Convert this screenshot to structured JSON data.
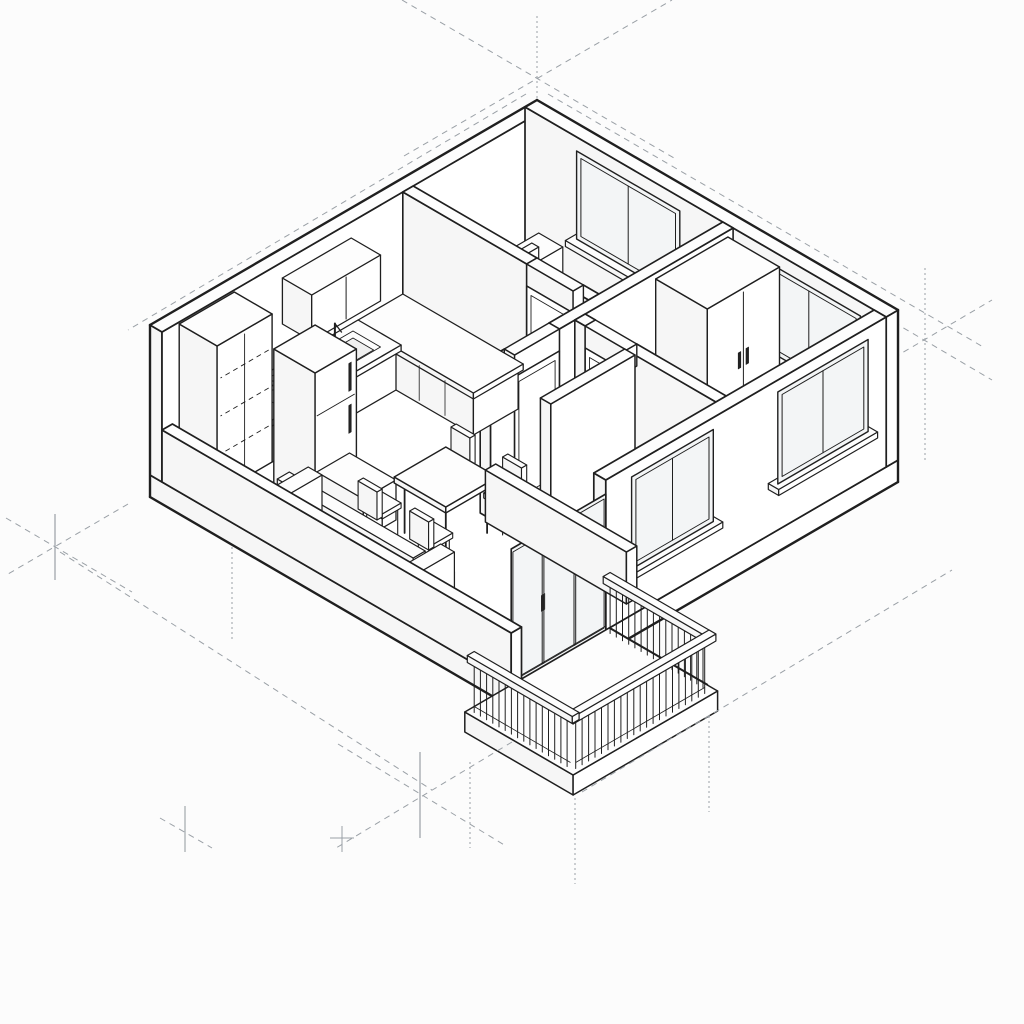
{
  "canvas": {
    "width": 1024,
    "height": 1024,
    "background": "#fcfcfc"
  },
  "drawing": {
    "type": "isometric-cutaway-floor-plan",
    "colors": {
      "line": "#1f1f1f",
      "soft": "#555555",
      "fill": "#ffffff",
      "fill_side": "#f6f6f6",
      "fill_top": "#fdfdfd",
      "glass": "#f3f5f6",
      "recess": "#f0f0f0",
      "guide": "#9aa0a6",
      "handle": "#222222"
    },
    "rooms": [
      {
        "name": "bedroom-1",
        "objects": [
          "double-bed",
          "headboard",
          "pillow",
          "pillow",
          "blanket",
          "nightstand",
          "nightstand",
          "window"
        ]
      },
      {
        "name": "bedroom-2",
        "objects": [
          "wardrobe",
          "window-back",
          "window-side"
        ]
      },
      {
        "name": "bathroom",
        "objects": [
          "washbasin",
          "toilet",
          "bidet",
          "window"
        ]
      },
      {
        "name": "kitchen",
        "objects": [
          "wall-cabinets",
          "counter",
          "sink",
          "faucet",
          "cooktop-4-burners",
          "pot",
          "tall-cabinet",
          "refrigerator",
          "base-cabinet"
        ]
      },
      {
        "name": "living-dining",
        "objects": [
          "dining-table",
          "chair",
          "chair",
          "chair",
          "chair",
          "sofa-3-seat"
        ]
      },
      {
        "name": "balcony",
        "objects": [
          "sliding-glass-door",
          "railing-balusters",
          "handrail",
          "slab"
        ]
      }
    ],
    "doors": [
      "bedroom-1-door-with-swing-arc",
      "bedroom-2-door-with-swing-arc",
      "hall-door-with-swing-arc",
      "balcony-sliding-door"
    ],
    "guides": [
      "apex-axis-cross",
      "roofline-extension-dashes",
      "west-axis-cross",
      "east-axis-cross",
      "south-axis-cross",
      "dotted-drop-lines",
      "long-dashed-baseline"
    ]
  }
}
